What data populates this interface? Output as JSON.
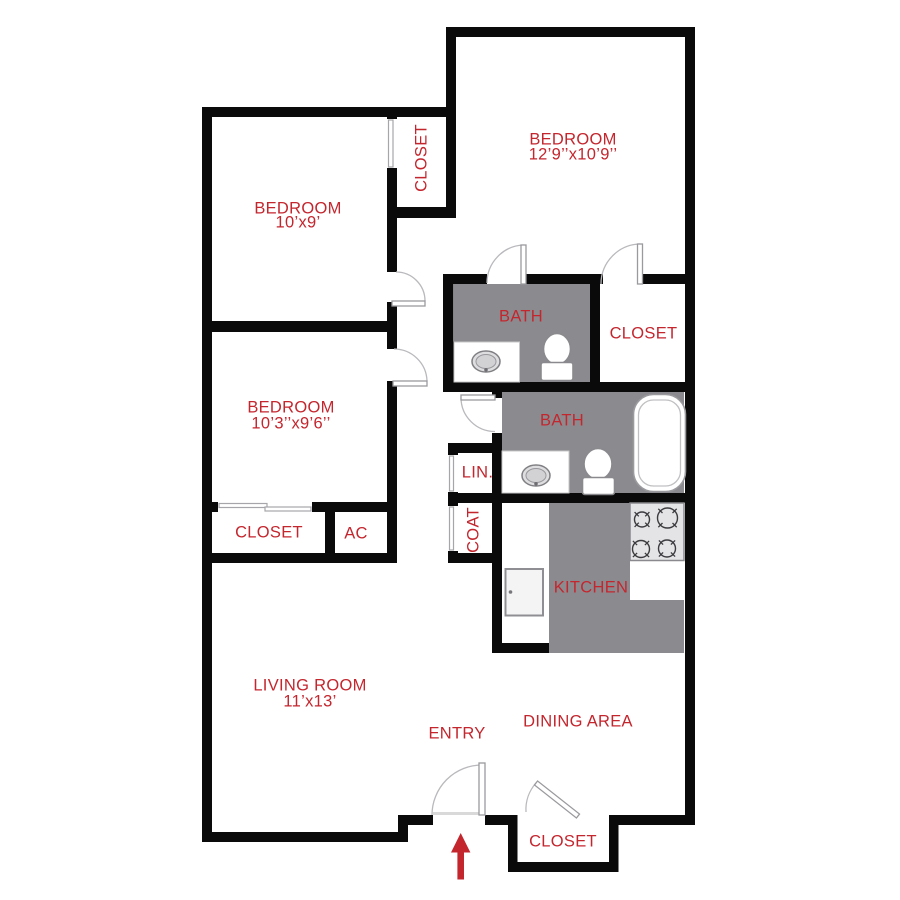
{
  "title": "Two bedroom apartment floor plan",
  "colors": {
    "label_red": "#c4262e",
    "wall_black": "#0a0a0a",
    "floor_gray": "#8b8b8f"
  },
  "rooms": {
    "bedroom_top_right": {
      "label": "BEDROOM",
      "dims": "12’9’’x10’9’’"
    },
    "bedroom_top_left": {
      "label": "BEDROOM",
      "dims": "10’x9’"
    },
    "bedroom_middle": {
      "label": "BEDROOM",
      "dims": "10’3’’x9’6’’"
    },
    "living_room": {
      "label": "LIVING ROOM",
      "dims": "11’x13’"
    },
    "dining_area": {
      "label": "DINING AREA"
    },
    "entry": {
      "label": "ENTRY"
    },
    "kitchen": {
      "label": "KITCHEN"
    },
    "bath_upper": {
      "label": "BATH"
    },
    "bath_lower": {
      "label": "BATH"
    },
    "closet_bedroom_top_left": {
      "label": "CLOSET"
    },
    "closet_bedroom_top_right": {
      "label": "CLOSET"
    },
    "closet_bedroom_middle": {
      "label": "CLOSET"
    },
    "closet_entry": {
      "label": "CLOSET"
    },
    "linen": {
      "label": "LIN."
    },
    "coat": {
      "label": "COAT"
    },
    "ac": {
      "label": "AC"
    }
  }
}
